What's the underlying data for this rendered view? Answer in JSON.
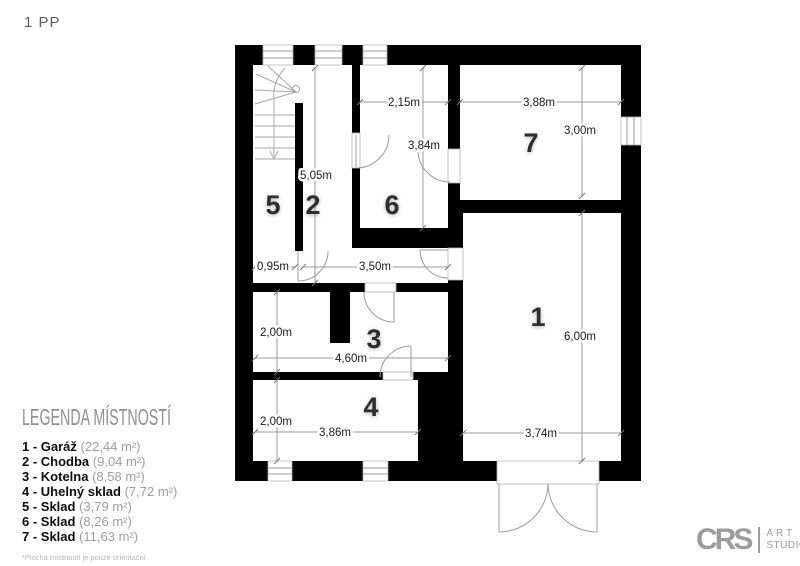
{
  "page": {
    "title": "1 PP"
  },
  "colors": {
    "wall": "#000000",
    "drawing_lines": "#9b9b9b",
    "dim_text": "#1a1a1a",
    "logo_gray": "#9c9c9c"
  },
  "plan": {
    "rooms": {
      "r1": "1",
      "r2": "2",
      "r3": "3",
      "r4": "4",
      "r5": "5",
      "r6": "6",
      "r7": "7"
    },
    "dims": {
      "room6_width": "2,15m",
      "room7_width": "3,88m",
      "room7_height": "3,00m",
      "room6_height": "3,84m",
      "room2_height": "5,05m",
      "passage_width": "0,95m",
      "corridor_width": "3,50m",
      "room3_height": "2,00m",
      "room3_width": "4,60m",
      "room4_height": "2,00m",
      "room4_width": "3,86m",
      "room1_height": "6,00m",
      "room1_width": "3,74m"
    }
  },
  "legend": {
    "title": "LEGENDA MÍSTNOSTÍ",
    "items": [
      {
        "label": "1 - Garáž",
        "area": " (22,44 m²)"
      },
      {
        "label": "2 - Chodba",
        "area": " (9,04 m²)"
      },
      {
        "label": "3 - Kotelna",
        "area": " (8,58 m²)"
      },
      {
        "label": "4 - Uhelný sklad",
        "area": " (7,72 m²)"
      },
      {
        "label": "5 - Sklad",
        "area": " (3,79 m²)"
      },
      {
        "label": "6 - Sklad",
        "area": " (8,26 m²)"
      },
      {
        "label": "7 - Sklad",
        "area": " (11,63 m²)"
      }
    ],
    "footnote": "*Plocha místností je pouze orientační"
  },
  "logo": {
    "initials": "CRS",
    "line1": "ART",
    "line2": "STUDIO"
  }
}
